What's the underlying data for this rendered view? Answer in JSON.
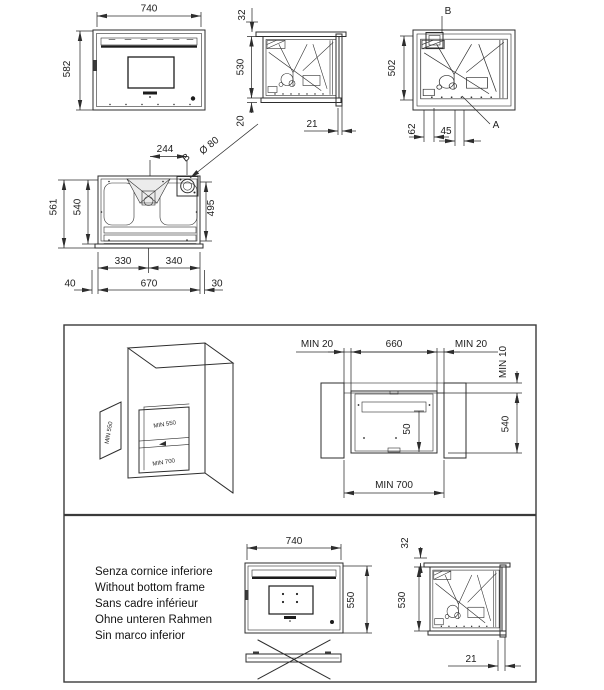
{
  "views": {
    "front": {
      "w": "740",
      "h": "582"
    },
    "side_mid": {
      "top": "32",
      "h": "530",
      "bottom": "20",
      "offset": "21"
    },
    "side_right": {
      "h": "502",
      "d62": "62",
      "d45": "45",
      "callout_a": "A",
      "callout_b": "B"
    },
    "plan": {
      "d244": "244",
      "callout_b": "B",
      "flue": "Ø 80",
      "d561": "561",
      "d540": "540",
      "d495": "495",
      "d330": "330",
      "d340": "340",
      "d40": "40",
      "d670": "670",
      "d30": "30"
    },
    "iso": {
      "panel": "MIN 550",
      "top": "MIN 550",
      "bottom": "MIN 700"
    },
    "niche": {
      "left": "MIN 20",
      "center": "660",
      "right": "MIN 20",
      "top_right": "MIN 10",
      "height": "540",
      "inner": "50",
      "bottom": "MIN 700"
    },
    "noframe": {
      "notes": [
        "Senza cornice inferiore",
        "Without bottom frame",
        "Sans cadre inférieur",
        "Ohne unteren Rahmen",
        "Sin marco inferior"
      ],
      "front": {
        "w": "740",
        "h": "550"
      },
      "side": {
        "top": "32",
        "h": "530",
        "offset": "21"
      }
    }
  },
  "colors": {
    "line": "#2d2d2d",
    "panel_fill": "#e4e4e4",
    "dark": "#1c1c1c"
  }
}
